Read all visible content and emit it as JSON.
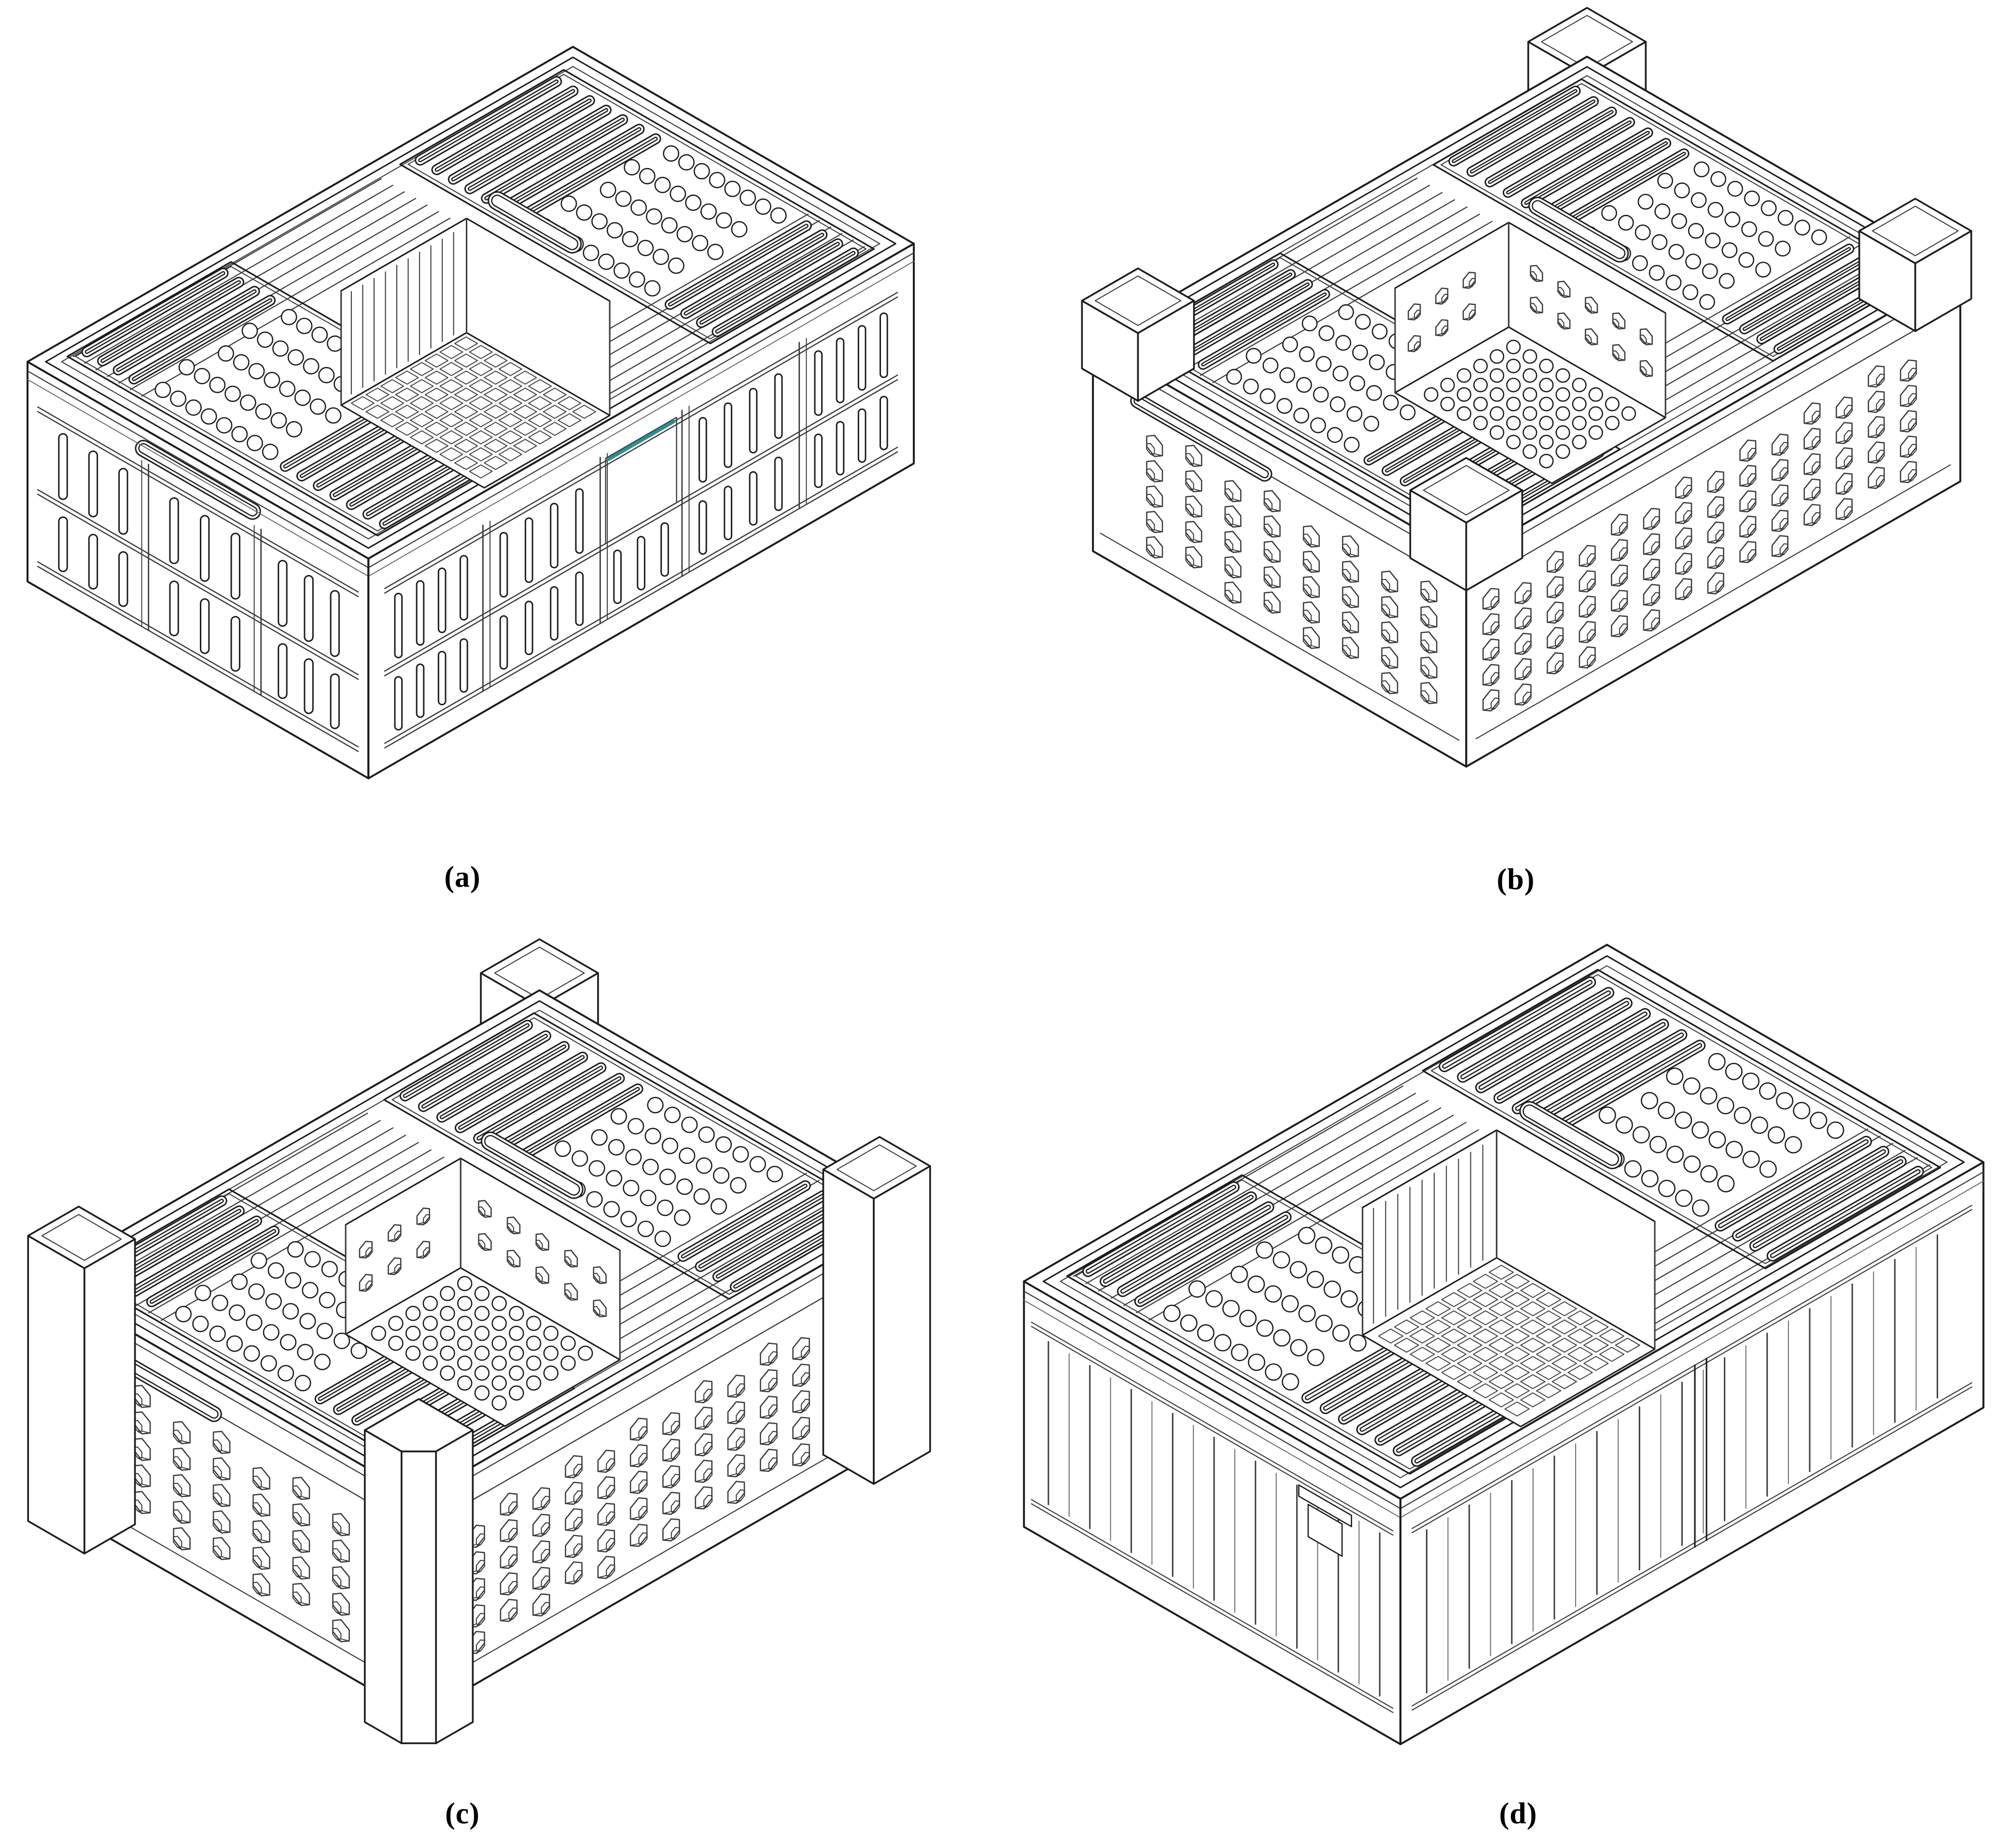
{
  "page": {
    "type": "journal-figure",
    "background": "#ffffff"
  },
  "colors": {
    "line": "#1c1c1c",
    "detail": "#3c3c3c",
    "thin": "#6b6b6b",
    "fill": "#ffffff",
    "accent_teal": "#2a8f8f"
  },
  "figures": [
    {
      "id": "a",
      "label": "(a)",
      "name": "vented collapsible crate with slotted rib side panels"
    },
    {
      "id": "b",
      "label": "(b)",
      "name": "vented crate with hexagonal wall perforations and corner stacking caps"
    },
    {
      "id": "c",
      "label": "(c)",
      "name": "vented crate with hexagonal wall perforations and full-height corner posts"
    },
    {
      "id": "d",
      "label": "(d)",
      "name": "vented crate with vertical slatted walls"
    }
  ]
}
